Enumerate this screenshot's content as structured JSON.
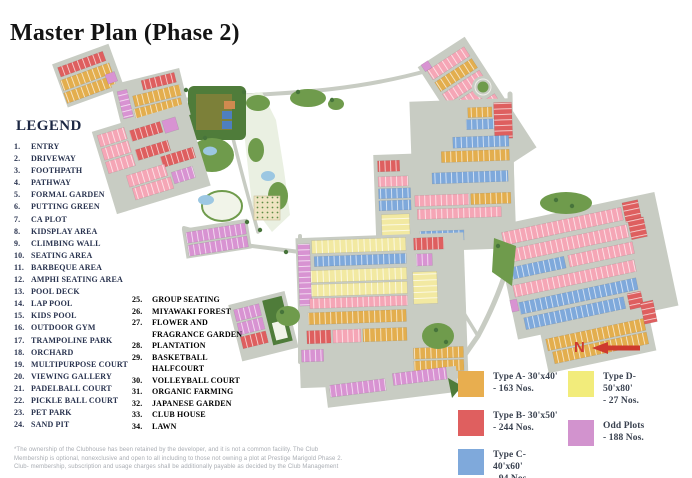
{
  "title": "Master Plan (Phase 2)",
  "legend": {
    "heading": "LEGEND",
    "column1": [
      {
        "num": "1.",
        "label": "ENTRY"
      },
      {
        "num": "2.",
        "label": "DRIVEWAY"
      },
      {
        "num": "3.",
        "label": "FOOTHPATH"
      },
      {
        "num": "4.",
        "label": "PATHWAY"
      },
      {
        "num": "5.",
        "label": "FORMAL GARDEN"
      },
      {
        "num": "6.",
        "label": "PUTTING GREEN"
      },
      {
        "num": "7.",
        "label": "CA PLOT"
      },
      {
        "num": "8.",
        "label": "KIDSPLAY AREA"
      },
      {
        "num": "9.",
        "label": "CLIMBING WALL"
      },
      {
        "num": "10.",
        "label": "SEATING AREA"
      },
      {
        "num": "11.",
        "label": "BARBEQUE AREA"
      },
      {
        "num": "12.",
        "label": "AMPHI SEATING AREA"
      },
      {
        "num": "13.",
        "label": "POOL DECK"
      },
      {
        "num": "14.",
        "label": "LAP POOL"
      },
      {
        "num": "15.",
        "label": "KIDS POOL"
      },
      {
        "num": "16.",
        "label": "OUTDOOR GYM"
      },
      {
        "num": "17.",
        "label": "TRAMPOLINE PARK"
      },
      {
        "num": "18.",
        "label": "ORCHARD"
      },
      {
        "num": "19.",
        "label": "MULTIPURPOSE COURT"
      },
      {
        "num": "20.",
        "label": "VIEWING GALLERY"
      },
      {
        "num": "21.",
        "label": "PADELBALL COURT"
      },
      {
        "num": "22.",
        "label": "PICKLE BALL COURT"
      },
      {
        "num": "23.",
        "label": "PET PARK"
      },
      {
        "num": "24.",
        "label": "SAND PIT"
      }
    ],
    "column2": [
      {
        "num": "25.",
        "label": "GROUP SEATING"
      },
      {
        "num": "26.",
        "label": "MIYAWAKI FOREST"
      },
      {
        "num": "27.",
        "label": "FLOWER AND FRAGRANCE GARDEN"
      },
      {
        "num": "28.",
        "label": "PLANTATION"
      },
      {
        "num": "29.",
        "label": "BASKETBALL HALFCOURT"
      },
      {
        "num": "30.",
        "label": "VOLLEYBALL COURT"
      },
      {
        "num": "31.",
        "label": "ORGANIC FARMING"
      },
      {
        "num": "32.",
        "label": "JAPANESE GARDEN"
      },
      {
        "num": "33.",
        "label": "CLUB HOUSE"
      },
      {
        "num": "34.",
        "label": "LAWN"
      }
    ]
  },
  "plot_legend": {
    "items": [
      {
        "id": "type-a",
        "color": "#E8AE4F",
        "line1": "Type A- 30'x40'",
        "line2": "- 163 Nos."
      },
      {
        "id": "type-b",
        "color": "#DF5F5F",
        "line1": "Type B- 30'x50'",
        "line2": "- 244 Nos."
      },
      {
        "id": "type-c",
        "color": "#7FA9DB",
        "line1": "Type C- 40'x60'",
        "line2": "- 94 Nos"
      },
      {
        "id": "type-d",
        "color": "#F2EC7B",
        "line1": "Type D- 50'x80'",
        "line2": "- 27 Nos."
      },
      {
        "id": "odd-plots",
        "color": "#D293CE",
        "line1": "Odd Plots",
        "line2": "- 188 Nos."
      }
    ]
  },
  "compass": {
    "label": "N",
    "color": "#CE3A2E"
  },
  "disclaimer": "*The ownership of the Clubhouse has been retained by the developer, and it is not a common facility. The Club Membership is optional, nonexclusive and open to all including to those not owning a plot at Prestige Marigold Phase 2. Club- membership, subscription and usage charges shall be additionally payable as decided by the Club Management",
  "map": {
    "palette": {
      "type_a_orange": "#E3AE4E",
      "type_b_red": "#DE5F5F",
      "type_c_blue": "#7FA9DB",
      "type_d_yellow": "#F2E9A2",
      "odd_plot_violet": "#D893D2",
      "row_pink": "#F5A6B6",
      "road_grey": "#C8CCC3",
      "park_green": "#6F9B4C",
      "dark_green": "#47743B",
      "clubhouse_olive": "#7C8039",
      "pond_blue": "#9CC7E2"
    }
  }
}
